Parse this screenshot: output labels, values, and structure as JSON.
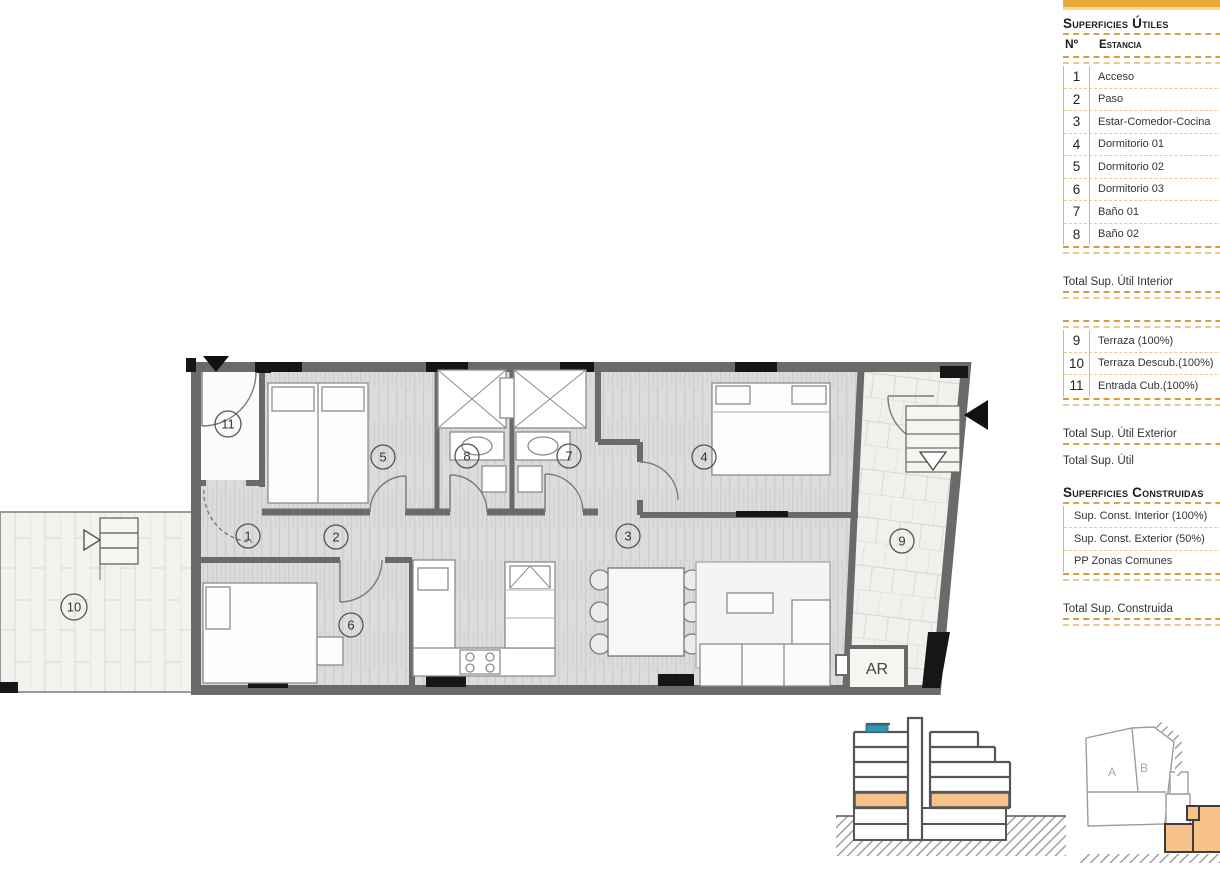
{
  "panel": {
    "title": "Superficies Útiles",
    "header": {
      "no": "Nº",
      "room": "Estancia"
    },
    "interior_rooms": [
      {
        "no": "1",
        "name": "Acceso"
      },
      {
        "no": "2",
        "name": "Paso"
      },
      {
        "no": "3",
        "name": "Estar-Comedor-Cocina"
      },
      {
        "no": "4",
        "name": "Dormitorio 01"
      },
      {
        "no": "5",
        "name": "Dormitorio 02"
      },
      {
        "no": "6",
        "name": "Dormitorio 03"
      },
      {
        "no": "7",
        "name": "Baño 01"
      },
      {
        "no": "8",
        "name": "Baño 02"
      }
    ],
    "total_interior_label": "Total Sup. Útil Interior",
    "exterior_rooms": [
      {
        "no": "9",
        "name": "Terraza (100%)"
      },
      {
        "no": "10",
        "name": "Terraza Descub.(100%)"
      },
      {
        "no": "11",
        "name": "Entrada Cub.(100%)"
      }
    ],
    "total_exterior_label": "Total Sup. Útil Exterior",
    "total_label": "Total Sup. Útil",
    "constructed_title": "Superficies Construidas",
    "constructed_rows": [
      {
        "name": "Sup. Const. Interior (100%)"
      },
      {
        "name": "Sup. Const. Exterior (50%)"
      },
      {
        "name": "PP Zonas Comunes"
      }
    ],
    "total_constructed_label": "Total Sup. Construida"
  },
  "plan": {
    "room_numbers": [
      "1",
      "2",
      "3",
      "4",
      "5",
      "6",
      "7",
      "8",
      "9",
      "10",
      "11"
    ],
    "ar_label": "AR"
  },
  "site_plan": {
    "block_a": "A",
    "block_b": "B"
  },
  "colors": {
    "accent_gold": "#E9A93B",
    "dash_gold": "#D69C3F",
    "highlight_orange": "#F6C289",
    "highlight_blue": "#2E96B4",
    "wall_gray": "#6A6A6A"
  }
}
